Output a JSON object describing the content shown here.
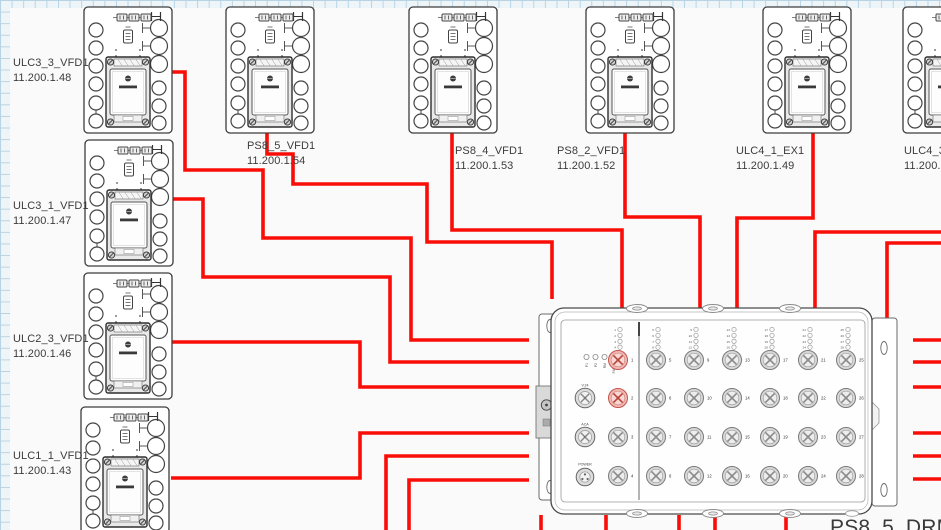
{
  "diagram": {
    "devices": [
      {
        "id": "ulc3-3-vfd1",
        "name": "ULC3_3_VFD1",
        "ip": "11.200.1.48"
      },
      {
        "id": "ulc3-1-vfd1",
        "name": "ULC3_1_VFD1",
        "ip": "11.200.1.47"
      },
      {
        "id": "ulc2-3-vfd1",
        "name": "ULC2_3_VFD1",
        "ip": "11.200.1.46"
      },
      {
        "id": "ulc1-1-vfd1",
        "name": "ULC1_1_VFD1",
        "ip": "11.200.1.43"
      },
      {
        "id": "ps8-5-vfd1",
        "name": "PS8_5_VFD1",
        "ip": "11.200.1.54"
      },
      {
        "id": "ps8-4-vfd1",
        "name": "PS8_4_VFD1",
        "ip": "11.200.1.53"
      },
      {
        "id": "ps8-2-vfd1",
        "name": "PS8_2_VFD1",
        "ip": "11.200.1.52"
      },
      {
        "id": "ulc4-1-ex1",
        "name": "ULC4_1_EX1",
        "ip": "11.200.1.49"
      },
      {
        "id": "ulc4-3",
        "name": "ULC4_3_",
        "ip": "11.200.1"
      }
    ],
    "switch": {
      "name": "PS8_5_DRM1",
      "status_leds": [
        "P1",
        "P2",
        "RM",
        "FAULT"
      ],
      "special_ports": [
        "V.24",
        "ACA",
        "POWER"
      ],
      "port_count": 28,
      "highlighted_ports": [
        1,
        2
      ]
    },
    "colors": {
      "wire": "#f90d07",
      "port_highlight": "#f1b6b0",
      "port_highlight_stroke": "#c2564e",
      "grid": "#b7d3e4"
    },
    "wires": [
      {
        "points": [
          [
            171,
            72
          ],
          [
            185,
            72
          ],
          [
            185,
            170
          ],
          [
            263,
            170
          ],
          [
            263,
            238
          ],
          [
            411,
            238
          ],
          [
            411,
            340
          ],
          [
            529,
            340
          ]
        ]
      },
      {
        "points": [
          [
            267,
            131
          ],
          [
            267,
            154
          ],
          [
            293,
            154
          ],
          [
            293,
            184
          ],
          [
            427,
            184
          ],
          [
            427,
            242
          ],
          [
            552,
            242
          ],
          [
            552,
            299
          ]
        ]
      },
      {
        "points": [
          [
            172,
            199
          ],
          [
            203,
            199
          ],
          [
            203,
            277
          ],
          [
            390,
            277
          ],
          [
            390,
            362
          ],
          [
            529,
            362
          ]
        ]
      },
      {
        "points": [
          [
            171,
            342
          ],
          [
            360,
            342
          ],
          [
            360,
            387
          ],
          [
            529,
            387
          ]
        ]
      },
      {
        "points": [
          [
            171,
            478
          ],
          [
            360,
            478
          ],
          [
            360,
            433
          ],
          [
            529,
            433
          ]
        ]
      },
      {
        "points": [
          [
            386,
            531
          ],
          [
            386,
            456
          ],
          [
            529,
            456
          ]
        ]
      },
      {
        "points": [
          [
            409,
            531
          ],
          [
            409,
            480
          ],
          [
            529,
            480
          ]
        ]
      },
      {
        "points": [
          [
            452,
            131
          ],
          [
            452,
            230
          ],
          [
            622,
            230
          ],
          [
            622,
            312
          ]
        ]
      },
      {
        "points": [
          [
            625,
            131
          ],
          [
            625,
            217
          ],
          [
            700,
            217
          ],
          [
            700,
            312
          ]
        ]
      },
      {
        "points": [
          [
            813,
            131
          ],
          [
            813,
            218
          ],
          [
            737,
            218
          ],
          [
            737,
            312
          ]
        ]
      },
      {
        "points": [
          [
            942,
            232
          ],
          [
            815,
            232
          ],
          [
            815,
            312
          ]
        ]
      },
      {
        "points": [
          [
            942,
            243
          ],
          [
            887,
            243
          ],
          [
            887,
            320
          ]
        ]
      },
      {
        "points": [
          [
            913,
            340
          ],
          [
            942,
            340
          ]
        ]
      },
      {
        "points": [
          [
            913,
            362
          ],
          [
            942,
            362
          ]
        ]
      },
      {
        "points": [
          [
            913,
            387
          ],
          [
            942,
            387
          ]
        ]
      },
      {
        "points": [
          [
            913,
            433
          ],
          [
            942,
            433
          ]
        ]
      },
      {
        "points": [
          [
            913,
            456
          ],
          [
            942,
            456
          ]
        ]
      },
      {
        "points": [
          [
            913,
            479
          ],
          [
            942,
            479
          ]
        ]
      },
      {
        "points": [
          [
            541,
            515
          ],
          [
            541,
            531
          ]
        ]
      },
      {
        "points": [
          [
            606,
            515
          ],
          [
            606,
            531
          ]
        ]
      },
      {
        "points": [
          [
            679,
            515
          ],
          [
            679,
            531
          ]
        ]
      },
      {
        "points": [
          [
            715,
            515
          ],
          [
            715,
            531
          ]
        ]
      },
      {
        "points": [
          [
            786,
            515
          ],
          [
            786,
            531
          ]
        ]
      }
    ]
  }
}
